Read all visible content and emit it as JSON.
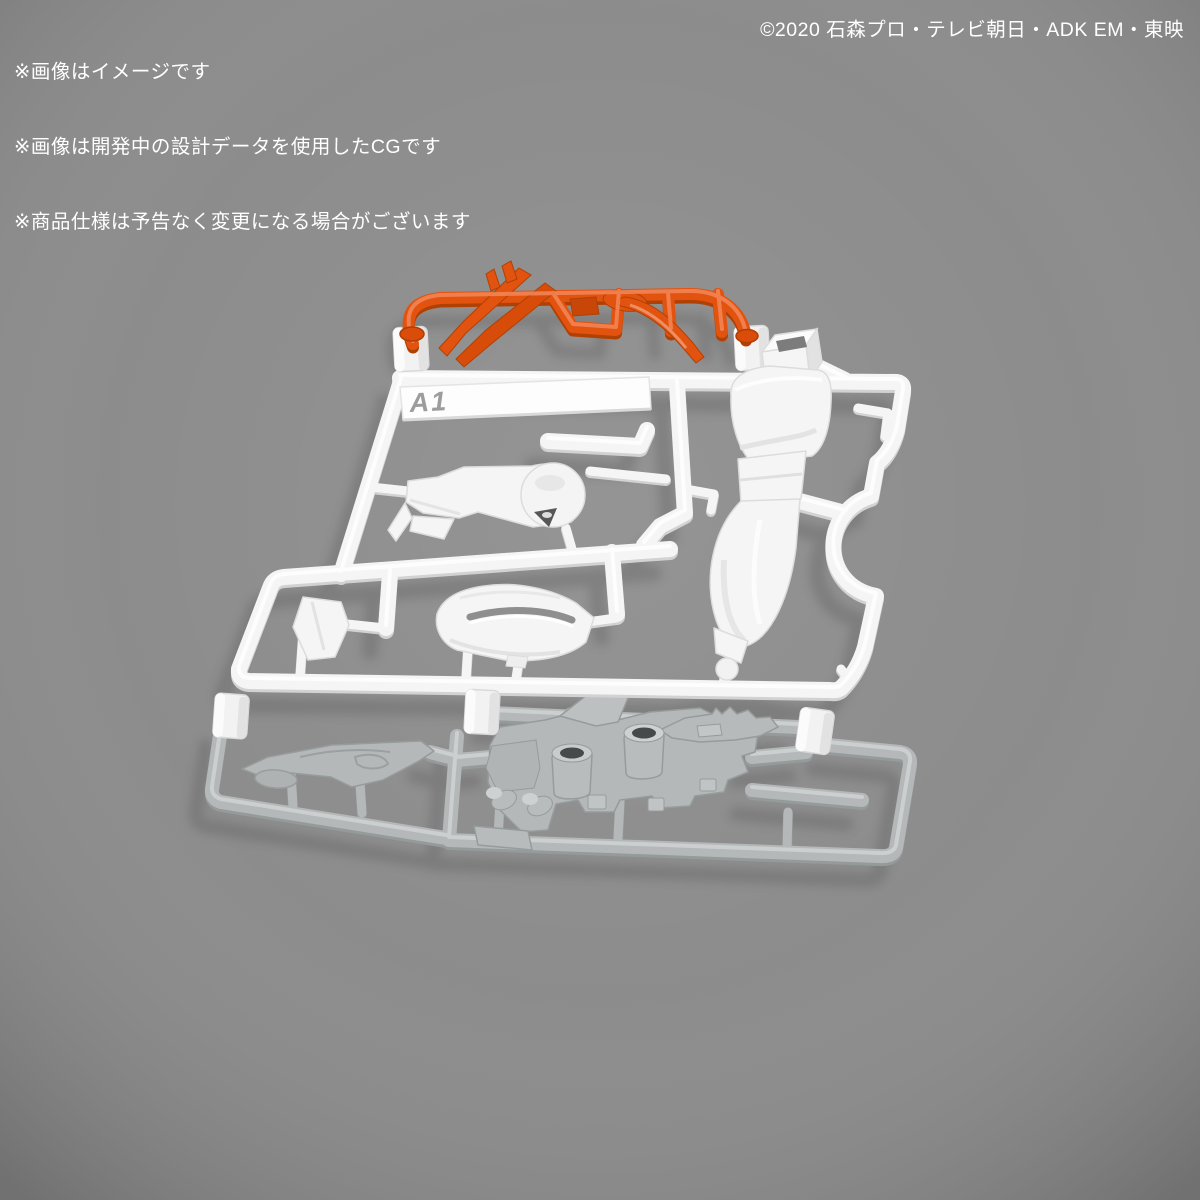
{
  "notices": {
    "lines": [
      "※画像はイメージです",
      "※画像は開発中の設計データを使用したCGです",
      "※商品仕様は予告なく変更になる場合がございます"
    ]
  },
  "copyright": "©2020 石森プロ・テレビ朝日・ADK EM・東映",
  "runner": {
    "label": "A1"
  },
  "colors": {
    "background": "#8a8a8a",
    "text": "#ffffff",
    "white-plastic": "#f5f5f5",
    "gray-plastic": "#b4b8b9",
    "orange-plastic": "#e2530f"
  }
}
